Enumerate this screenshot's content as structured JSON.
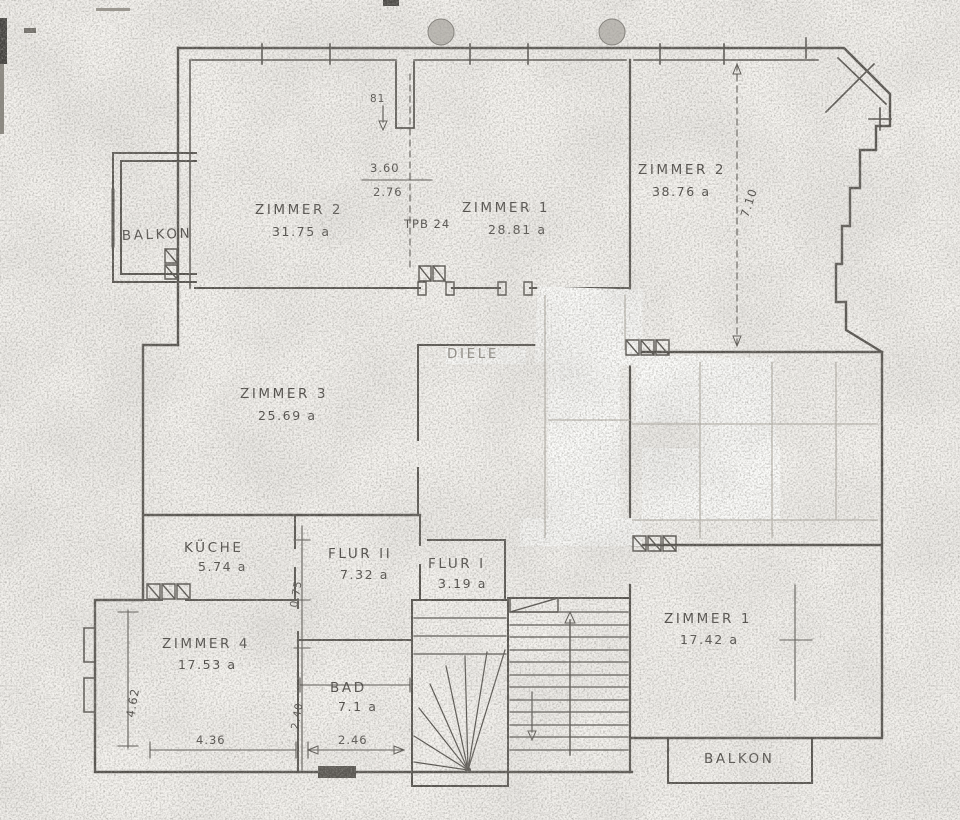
{
  "rooms": {
    "balkon_left": {
      "name": "BALKON"
    },
    "zimmer2_left": {
      "name": "ZIMMER 2",
      "area": "31.75 a"
    },
    "zimmer1_top": {
      "name": "ZIMMER 1",
      "area": "28.81 a"
    },
    "zimmer2_right": {
      "name": "ZIMMER 2",
      "area": "38.76 a"
    },
    "diele": {
      "name": "DIELE"
    },
    "zimmer3": {
      "name": "ZIMMER 3",
      "area": "25.69 a"
    },
    "kueche": {
      "name": "KÜCHE",
      "area": "5.74 a"
    },
    "flur2": {
      "name": "FLUR II",
      "area": "7.32 a"
    },
    "flur1": {
      "name": "FLUR I",
      "area": "3.19 a"
    },
    "zimmer4": {
      "name": "ZIMMER 4",
      "area": "17.53 a"
    },
    "zimmer1_right": {
      "name": "ZIMMER 1",
      "area": "17.42 a"
    },
    "bad": {
      "name": "BAD",
      "area": "7.1 a"
    },
    "balkon_right": {
      "name": "BALKON"
    }
  },
  "annotations": {
    "stamp": "TPB 24",
    "door_width": "81"
  },
  "dimensions": {
    "w_top_a": "3.60",
    "w_top_b": "2.76",
    "h_right": "7.10",
    "w_bottom_left": "4.36",
    "w_bottom_mid": "2.46",
    "h_left": "4.62",
    "h_mid_upper": "0.75",
    "h_mid_lower": "2.40"
  },
  "colors": {
    "paper": "#f5f3ef",
    "ink": "#54514c",
    "ink_faint": "#bcb8b0"
  }
}
